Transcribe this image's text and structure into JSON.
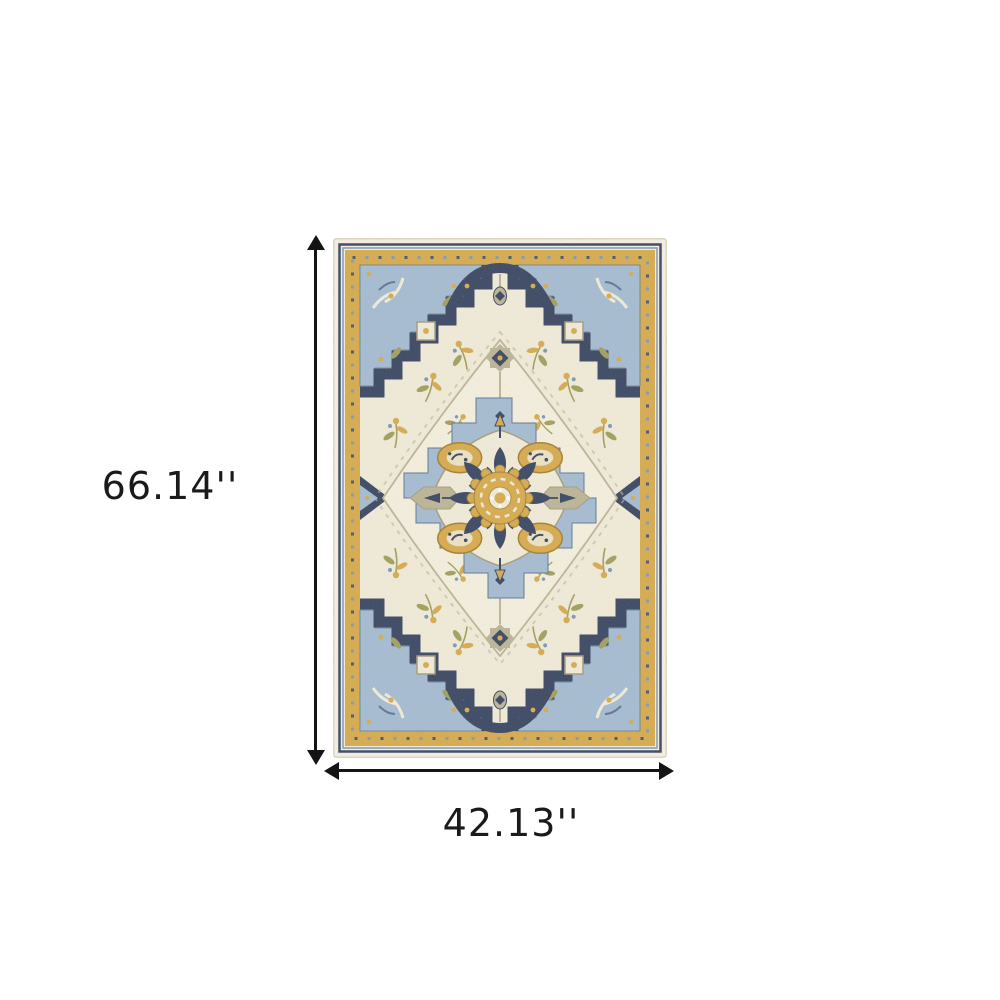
{
  "dimensions": {
    "height_label": "66.14''",
    "width_label": "42.13''"
  },
  "rug": {
    "style": "oriental-medallion-rug",
    "palette": {
      "cream": "#f4efe1",
      "ivory": "#f1ebd8",
      "ivory2": "#f4efdd",
      "blue": "#a6bcd1",
      "blue2": "#7d99b5",
      "blue-dk": "#5f7995",
      "navy": "#3d4964",
      "gold": "#d7ab50",
      "gold-dk": "#a8812f",
      "olive": "#a3a05e",
      "tan": "#a89e7c",
      "graytan": "#bdb597",
      "arrow": "#141414",
      "text": "#1a1a1a"
    }
  }
}
